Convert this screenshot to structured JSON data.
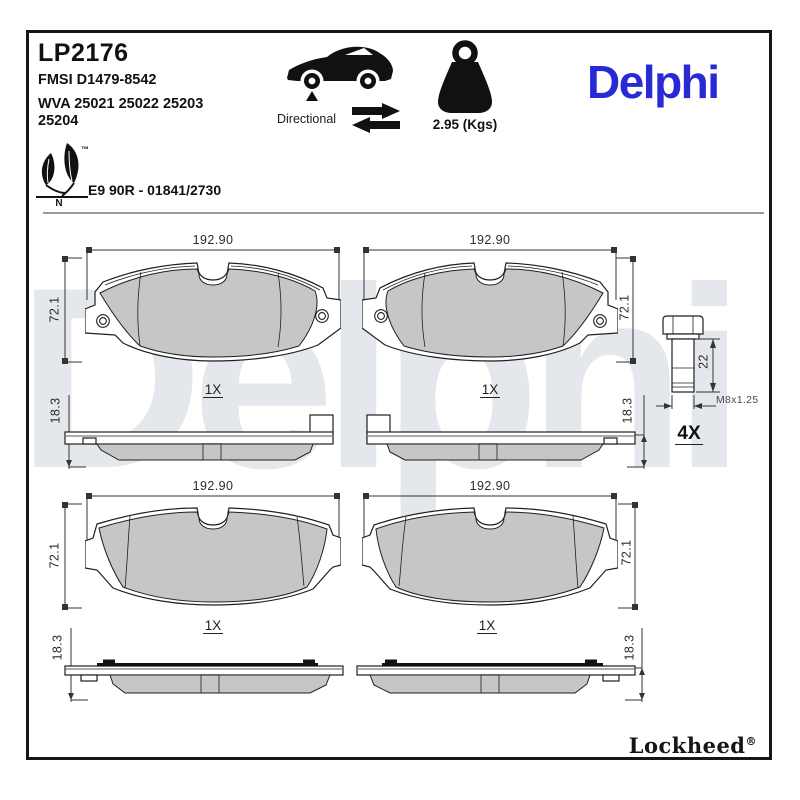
{
  "header": {
    "part_number": "LP2176",
    "fmsi": "FMSI D1479-8542",
    "wva_line1": "WVA 25021 25022 25203",
    "wva_line2": "25204",
    "directional_label": "Directional",
    "weight_label": "2.95 (Kgs)",
    "brand_logo": "Delphi",
    "eco_trademark": "™",
    "eco_letter": "N",
    "approval_code": "E9 90R - 01841/2730"
  },
  "drawings": {
    "pads": [
      {
        "width_label": "192.90",
        "height_label": "72.1",
        "qty_label": "1X",
        "thickness_label": "18.3"
      },
      {
        "width_label": "192.90",
        "height_label": "72.1",
        "qty_label": "1X",
        "thickness_label": "18.3"
      },
      {
        "width_label": "192.90",
        "height_label": "72.1",
        "qty_label": "1X",
        "thickness_label": "18.3"
      },
      {
        "width_label": "192.90",
        "height_label": "72.1",
        "qty_label": "1X",
        "thickness_label": "18.3"
      }
    ],
    "bolt": {
      "length_label": "22",
      "thread_label": "M8x1.25",
      "qty_label": "4X"
    }
  },
  "footer": {
    "brand": "Lockheed",
    "registered": "®"
  },
  "watermark": "Delphi",
  "colors": {
    "brand_blue": "#2929D6",
    "friction_gray": "#C6C6C6",
    "watermark_gray": "#E4E8EC"
  }
}
